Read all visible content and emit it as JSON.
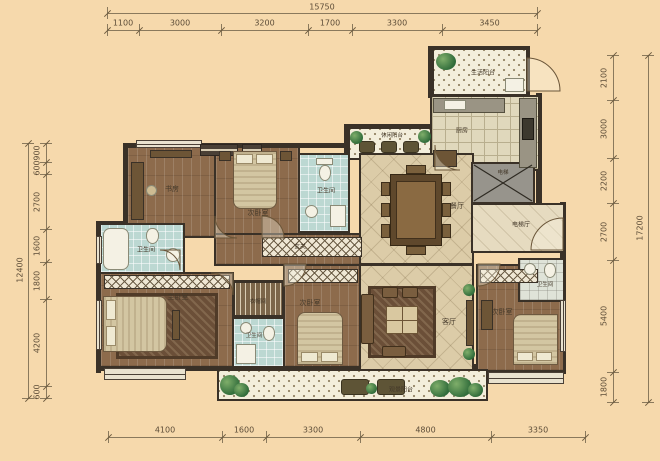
{
  "drawing": {
    "type": "apartment-floor-plan",
    "units": "mm"
  },
  "colors": {
    "background": "#f6d9ac",
    "wall": "#3a3127",
    "wood_floor": "#8d6b4c",
    "marble_floor": "#dccca8",
    "balcony_tile": "#f3eedb",
    "bath_tile": "#bcd8d2",
    "dimension_text": "#5d4d38"
  },
  "dims": {
    "top": {
      "total": "15750",
      "segments": [
        "1100",
        "3000",
        "3200",
        "1700",
        "3300",
        "3450"
      ]
    },
    "bottom": {
      "segments": [
        "4100",
        "1600",
        "3300",
        "4800",
        "3350"
      ]
    },
    "left": {
      "total": "12400",
      "segments": [
        "900",
        "600",
        "2700",
        "1600",
        "1800",
        "4200",
        "600"
      ]
    },
    "right": {
      "total": "17200",
      "segments": [
        "2100",
        "3000",
        "2200",
        "2700",
        "5400",
        "1800"
      ]
    }
  },
  "rooms": {
    "study": "书房",
    "bedroom2": "次卧室",
    "master": "主卧室",
    "bathroom": "卫生间",
    "cloakroom": "衣帽间",
    "dining": "餐厅",
    "living": "客厅",
    "kitchen": "厨房",
    "entry": "玄关",
    "elevator": "电梯",
    "elevator_hall": "电梯厅",
    "balcony_utility": "生活阳台",
    "balcony_leisure": "休闲阳台",
    "balcony_view": "观景阳台"
  }
}
